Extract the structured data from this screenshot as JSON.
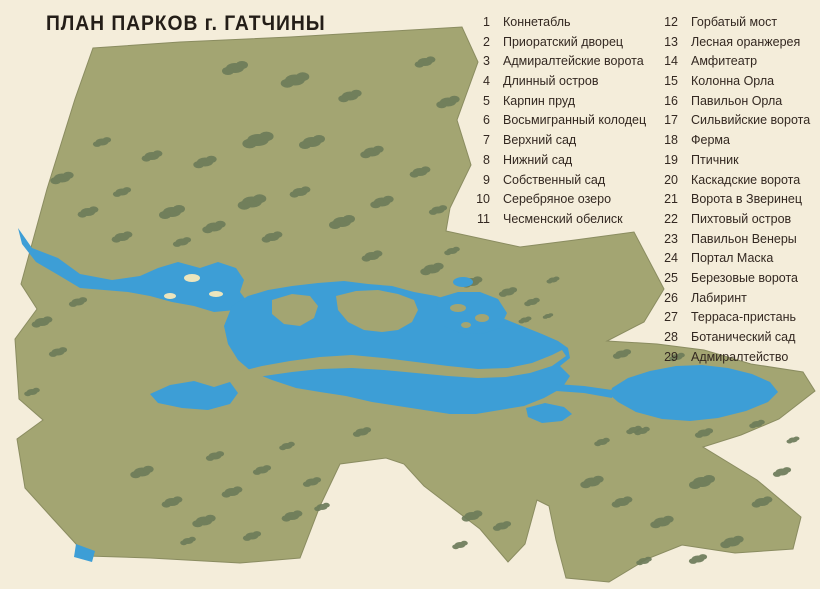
{
  "title": "ПЛАН ПАРКОВ г. ГАТЧИНЫ",
  "legend": {
    "items": [
      {
        "num": "1",
        "label": "Коннетабль"
      },
      {
        "num": "2",
        "label": "Приоратский дворец"
      },
      {
        "num": "3",
        "label": "Адмиралтейские ворота"
      },
      {
        "num": "4",
        "label": "Длинный остров"
      },
      {
        "num": "5",
        "label": "Карпин пруд"
      },
      {
        "num": "6",
        "label": "Восьмигранный колодец"
      },
      {
        "num": "7",
        "label": "Верхний сад"
      },
      {
        "num": "8",
        "label": "Нижний сад"
      },
      {
        "num": "9",
        "label": "Собственный сад"
      },
      {
        "num": "10",
        "label": "Серебряное озеро"
      },
      {
        "num": "11",
        "label": "Чесменский обелиск"
      },
      {
        "num": "12",
        "label": "Горбатый мост"
      },
      {
        "num": "13",
        "label": "Лесная оранжерея"
      },
      {
        "num": "14",
        "label": "Амфитеатр"
      },
      {
        "num": "15",
        "label": "Колонна Орла"
      },
      {
        "num": "16",
        "label": "Павильон Орла"
      },
      {
        "num": "17",
        "label": "Сильвийские ворота"
      },
      {
        "num": "18",
        "label": "Ферма"
      },
      {
        "num": "19",
        "label": "Птичник"
      },
      {
        "num": "20",
        "label": "Каскадские ворота"
      },
      {
        "num": "21",
        "label": "Ворота в Зверинец"
      },
      {
        "num": "22",
        "label": "Пихтовый остров"
      },
      {
        "num": "23",
        "label": "Павильон Венеры"
      },
      {
        "num": "24",
        "label": "Портал Маска"
      },
      {
        "num": "25",
        "label": "Березовые ворота"
      },
      {
        "num": "26",
        "label": "Лабиринт"
      },
      {
        "num": "27",
        "label": "Терраса-пристань"
      },
      {
        "num": "28",
        "label": "Ботанический сад"
      },
      {
        "num": "29",
        "label": "Адмиралтейство"
      }
    ]
  },
  "map": {
    "labels": {
      "zverinets": "Зверинец",
      "teplaya": "Теплая",
      "ostrov1": "Остров",
      "ostrov2": "любви",
      "oz_b": "о з.",
      "beloe": "Белое",
      "oz_ch": "оз.",
      "chernoe": "Черное",
      "silvia": "Сильвия",
      "dvorets": "Дворец"
    },
    "markers": [
      {
        "n": "1",
        "x": 622,
        "y": 459
      },
      {
        "n": "2",
        "x": 744,
        "y": 430
      },
      {
        "n": "3",
        "x": 577,
        "y": 383
      },
      {
        "n": "4",
        "x": 404,
        "y": 370
      },
      {
        "n": "4",
        "x": 558,
        "y": 410
      },
      {
        "n": "5",
        "x": 539,
        "y": 420
      },
      {
        "n": "6",
        "x": 505,
        "y": 421
      },
      {
        "n": "7",
        "x": 600,
        "y": 438
      },
      {
        "n": "8",
        "x": 543,
        "y": 471
      },
      {
        "n": "9",
        "x": 513,
        "y": 441
      },
      {
        "n": "10",
        "x": 482,
        "y": 397,
        "w": 1
      },
      {
        "n": "11",
        "x": 366,
        "y": 408
      },
      {
        "n": "12",
        "x": 371,
        "y": 367
      },
      {
        "n": "13",
        "x": 336,
        "y": 432
      },
      {
        "n": "14",
        "x": 315,
        "y": 492,
        "c": 1
      },
      {
        "n": "15",
        "x": 288,
        "y": 490
      },
      {
        "n": "16",
        "x": 343,
        "y": 359
      },
      {
        "n": "17",
        "x": 282,
        "y": 517
      },
      {
        "n": "18",
        "x": 148,
        "y": 488
      },
      {
        "n": "19",
        "x": 113,
        "y": 463
      },
      {
        "n": "20",
        "x": 188,
        "y": 422
      },
      {
        "n": "21",
        "x": 231,
        "y": 310
      },
      {
        "n": "22",
        "x": 311,
        "y": 322,
        "w": 1
      },
      {
        "n": "23",
        "x": 389,
        "y": 337,
        "w": 1
      },
      {
        "n": "24",
        "x": 409,
        "y": 261
      },
      {
        "n": "25",
        "x": 419,
        "y": 242
      },
      {
        "n": "26",
        "x": 492,
        "y": 314,
        "w": 1
      },
      {
        "n": "27",
        "x": 458,
        "y": 369
      },
      {
        "n": "28",
        "x": 583,
        "y": 291
      },
      {
        "n": "29",
        "x": 576,
        "y": 346
      }
    ]
  },
  "colors": {
    "paper": "#f4edda",
    "land": "#a3a572",
    "forest": "#6d7c5a",
    "water": "#3d9ed6",
    "stream": "#3398cb",
    "path": "#f2e7ad",
    "ink": "#1a1a1a",
    "water_label": "#0e3a63"
  }
}
